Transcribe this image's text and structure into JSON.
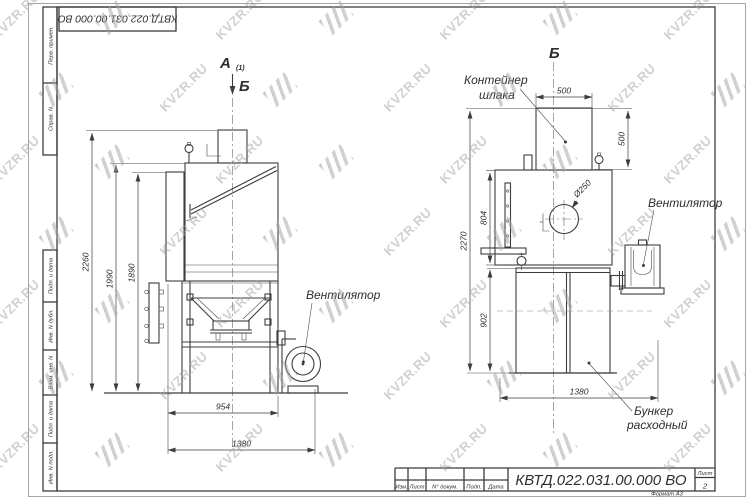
{
  "watermark": {
    "text": "KVZR.RU"
  },
  "colors": {
    "line": "#3c3c3c",
    "watermark": "#9fa5ab",
    "paper": "#ffffff"
  },
  "corner_stamp": {
    "doc_number": "КВТД.022.031.00.000  ВО"
  },
  "side_column": {
    "cell_1": "Перв. примен.",
    "cell_2": "Справ. N",
    "cell_3": "Подп. и дата",
    "cell_4": "Инв. N дубл.",
    "cell_5": "Взам. инв. N",
    "cell_6": "Подп. и дата",
    "cell_7": "Инв. N подл."
  },
  "view_a": {
    "title": "А",
    "title_suffix": "(1)",
    "section_mark": "Б",
    "dim_total_height": "2260",
    "dim_body_height": "1990",
    "dim_duct_height": "1890",
    "dim_frame_width": "954",
    "dim_total_width": "1380",
    "label_fan": "Вентилятор"
  },
  "view_b": {
    "title": "Б",
    "label_container_1": "Контейнер",
    "label_container_2": "шлака",
    "dim_container_width": "500",
    "dim_container_height": "500",
    "dim_total_height": "2270",
    "dim_body_height": "804",
    "dim_bunker_height": "902",
    "dim_total_width": "1380",
    "dim_inlet": "Ø250",
    "label_fan": "Вентилятор",
    "label_bunker_1": "Бункер",
    "label_bunker_2": "расходный"
  },
  "title_block": {
    "doc_number": "КВТД.022.031.00.000  ВО",
    "col_izm": "Изм.",
    "col_list": "Лист",
    "col_dokum": "N° докум.",
    "col_podp": "Подп.",
    "col_data": "Дата",
    "sheet_label": "Лист",
    "sheet_number": "2",
    "format_note": "Формат А3"
  }
}
